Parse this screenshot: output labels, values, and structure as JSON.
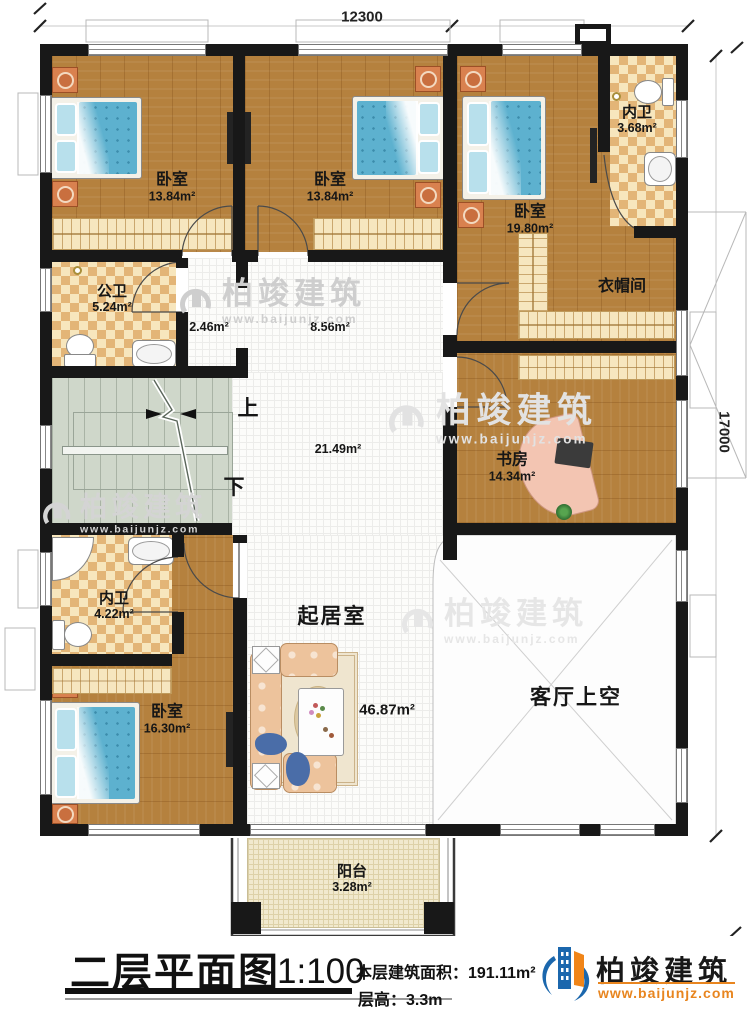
{
  "dimensions": {
    "top": "12300",
    "right": "17000"
  },
  "rooms": {
    "bedroom1": {
      "name": "卧室",
      "area": "13.84m²"
    },
    "bedroom2": {
      "name": "卧室",
      "area": "13.84m²"
    },
    "bedroom3": {
      "name": "卧室",
      "area": "19.80m²"
    },
    "ensuite_top": {
      "name": "内卫",
      "area": "3.68m²"
    },
    "closet": {
      "name": "衣帽间"
    },
    "public_bath": {
      "name": "公卫",
      "area": "5.24m²"
    },
    "hall_small": {
      "area": "2.46m²"
    },
    "hall_mid": {
      "area": "8.56m²"
    },
    "hall_large": {
      "area": "21.49m²"
    },
    "study": {
      "name": "书房",
      "area": "14.34m²"
    },
    "ensuite_bottom": {
      "name": "内卫",
      "area": "4.22m²"
    },
    "bedroom4": {
      "name": "卧室",
      "area": "16.30m²"
    },
    "living": {
      "name": "起居室",
      "area": "46.87m²"
    },
    "void": {
      "name": "客厅上空"
    },
    "balcony": {
      "name": "阳台",
      "area": "3.28m²"
    }
  },
  "stairs": {
    "up": "上",
    "down": "下"
  },
  "footer": {
    "title": "二层平面图",
    "scale": "1:100",
    "area": "本层建筑面积：191.11m²",
    "floor_height": "层高：3.3m"
  },
  "brand": {
    "name": "柏竣建筑",
    "url": "www.baijunjz.com"
  }
}
